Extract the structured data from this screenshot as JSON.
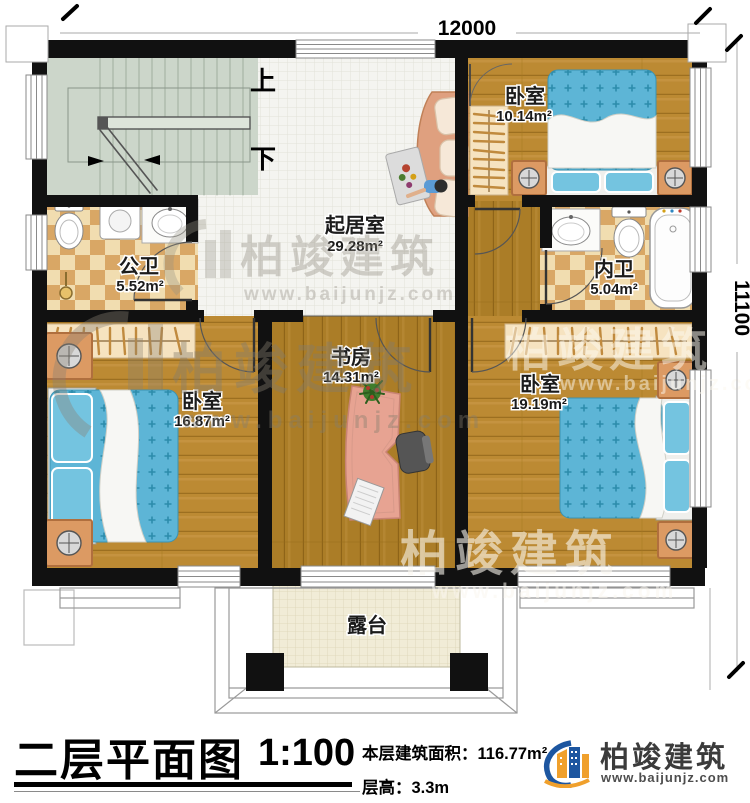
{
  "plan": {
    "dimensions": {
      "width": "12000",
      "height": "11100"
    },
    "stairs": {
      "up": "上",
      "down": "下"
    },
    "rooms": {
      "bedroom_top": {
        "name": "卧室",
        "area": "10.14m²"
      },
      "living": {
        "name": "起居室",
        "area": "29.28m²"
      },
      "bath_public": {
        "name": "公卫",
        "area": "5.52m²"
      },
      "bath_ensuite": {
        "name": "内卫",
        "area": "5.04m²"
      },
      "study": {
        "name": "书房",
        "area": "14.31m²"
      },
      "bedroom_left": {
        "name": "卧室",
        "area": "16.87m²"
      },
      "bedroom_right": {
        "name": "卧室",
        "area": "19.19m²"
      },
      "terrace": {
        "name": "露台"
      }
    },
    "watermark": {
      "brand": "柏竣建筑",
      "url": "www.baijunjz.com"
    }
  },
  "footer": {
    "title": "二层平面图",
    "scale": "1:100",
    "area_label": "本层建筑面积：",
    "area_value": "116.77m²",
    "floor_height_label": "层高：",
    "floor_height_value": "3.3m",
    "brand": "柏竣建筑",
    "website": "www.baijunjz.com"
  },
  "colors": {
    "wall": "#111111",
    "bed_blue": "#5db5d6",
    "brand_blue": "#1d56a0",
    "brand_orange": "#f0a02c"
  }
}
